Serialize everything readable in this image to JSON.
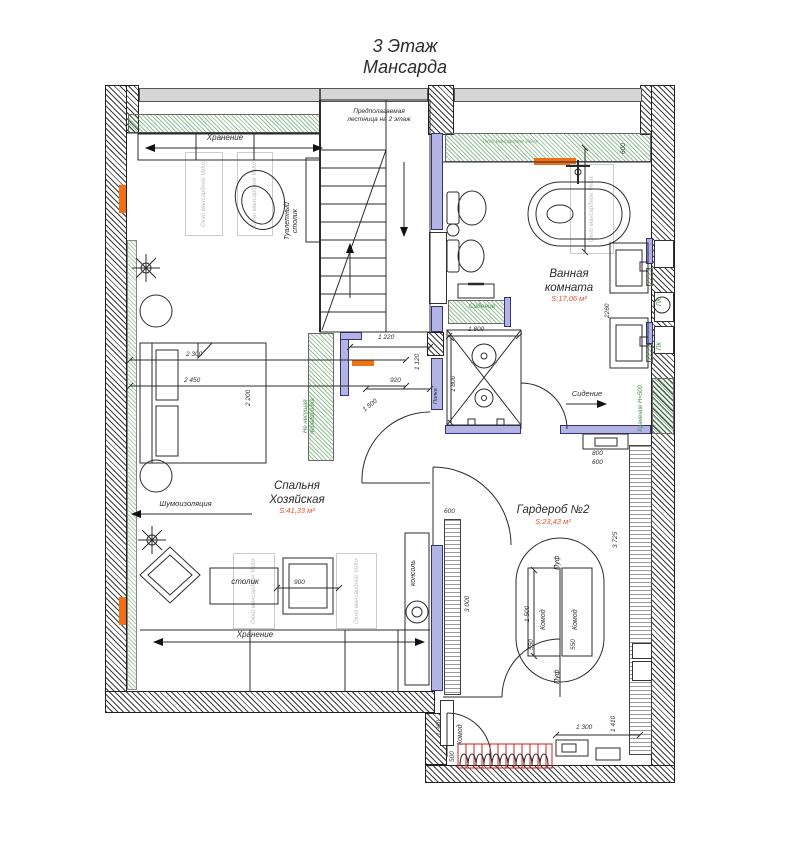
{
  "title": {
    "line1": "3 Этаж",
    "line2": "Мансарда"
  },
  "rooms": {
    "bedroom": {
      "line1": "Спальня",
      "line2": "Хозяйская",
      "area": "S:41,33 м²"
    },
    "bathroom": {
      "line1": "Ванная",
      "line2": "комната",
      "area": "S:17,06 м²"
    },
    "wardrobe": {
      "line1": "Гардероб №2",
      "area": "S:23,43 м²"
    }
  },
  "labels": {
    "storage": "Хранение",
    "soundproofing": "Шумоизоляция",
    "stairs_line1": "Предполагаемая",
    "stairs_line2": "лестница на 2 этаж",
    "vanity_line1": "Туалетный",
    "vanity_line2": "столик",
    "velux_window": "Окно мансардное Velux",
    "seat": "Сидение",
    "shelf": "Полка",
    "partition_line1": "Не несущая",
    "partition_line2": "перегородка",
    "side_table": "столик",
    "console": "консоль",
    "pouf": "Пуф",
    "dresser": "Комод",
    "storage_h500": "Хранение Н=500",
    "pk": "ПК"
  },
  "dimensions": {
    "bed_width_1": "2 300",
    "bed_width_2": "2 450",
    "bed_length": "2 200",
    "landing_width": "1 220",
    "landing_opening": "920",
    "door_swing": "1 500",
    "landing_depth": "1 120",
    "shower_width": "1 800",
    "shower_depth": "1 800",
    "vanity_run": "2260",
    "bath_width": "600",
    "bench_1": "800",
    "bench_2": "600",
    "rack_depth": "600",
    "island_length": "1 500",
    "island_width_1": "550",
    "island_width_2": "550",
    "chair": "900",
    "wardrobe_length": "3 725",
    "wardrobe_left": "3 000",
    "bottom_bench": "1 300",
    "bottom_right": "1 410",
    "bottom_left": "1 360",
    "bottom_small": "500"
  },
  "colors": {
    "wall": "#2f2f2f",
    "partition": "#b4b4e4",
    "insulation": "#3f8f3f",
    "accent": "#f07018",
    "area_text": "#e4542c",
    "radiator": "#cc2222"
  }
}
